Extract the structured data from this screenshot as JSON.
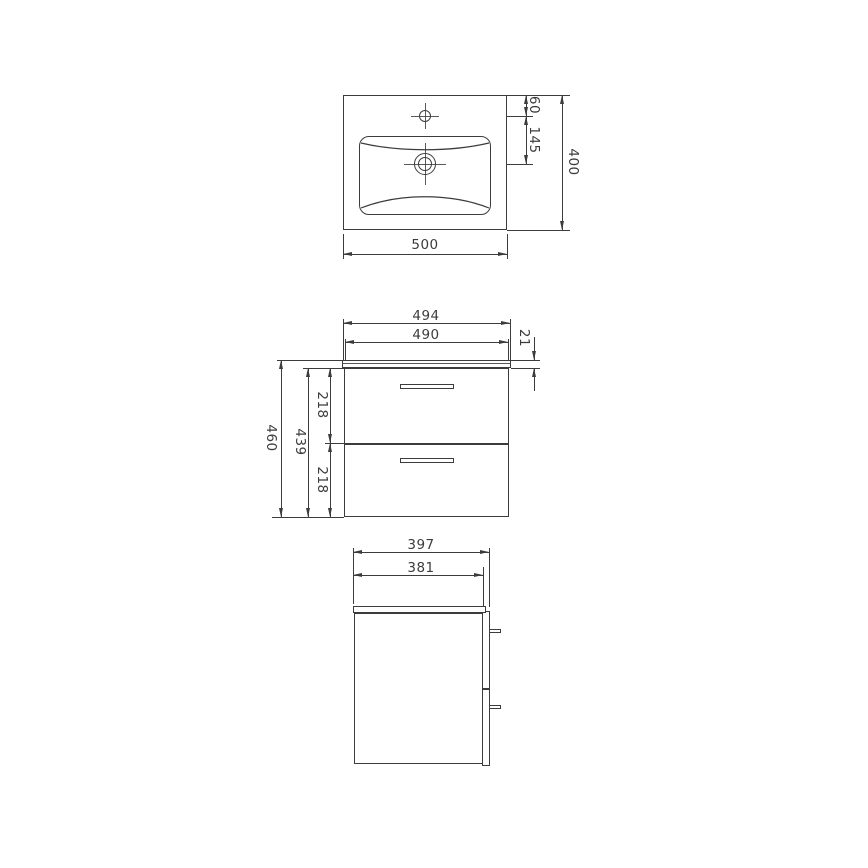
{
  "app": {
    "type": "technical-drawing",
    "subject": "wall-hung bathroom vanity unit with washbasin, dimensioned orthographic views"
  },
  "colors": {
    "line": "#3c3c3c",
    "background": "#ffffff"
  },
  "views": {
    "top": {
      "name": "washbasin-plan-view",
      "width": "500",
      "depth": "400",
      "faucet_from_back": "60",
      "faucet_to_drain": "145"
    },
    "front": {
      "name": "cabinet-front-view",
      "countertop_width": "494",
      "cabinet_width": "490",
      "countertop_thickness": "21",
      "total_height": "460",
      "cabinet_height": "439",
      "drawer_top_height": "218",
      "drawer_bottom_height": "218"
    },
    "side": {
      "name": "cabinet-side-view",
      "total_depth": "397",
      "cabinet_depth": "381"
    }
  }
}
